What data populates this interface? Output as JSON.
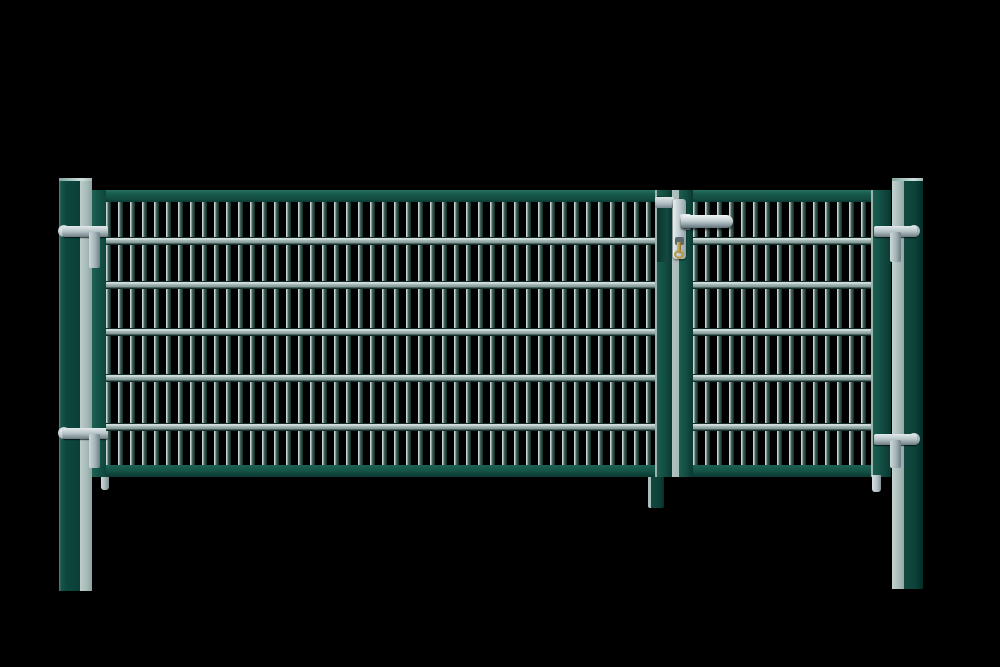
{
  "meta": {
    "description": "Product photograph on a black background: a green (moss-green RAL 6005) double-leaf driveway gate with galvanized double-wire mesh infill, mounted between two square green posts; chrome lever handle with brass key at the centre lock stile.",
    "background": "black"
  },
  "colors": {
    "bg": "#000000",
    "frame-green": "#15594c",
    "post-light": "#a7bbb9",
    "post-light-hi": "#bccbc9",
    "mesh-bar-light": "#c6d5d3",
    "rail-dark": "#142e29",
    "metal-light": "#e3eaec",
    "metal-mid": "#b4c2c6",
    "metal-dark": "#6c7c82",
    "brass": "#b89a4d",
    "brass-dark": "#7a6526"
  },
  "mesh": {
    "rail_offsets_px": [
      35,
      79,
      126,
      172,
      221
    ],
    "rail_height_px": 8,
    "vertical_bar_period_px": 12,
    "horizontal_rails_per_wing": 5
  },
  "scene": {
    "posts": [
      "left square post, dark green front with lit grey-green side",
      "right square post, lit grey-green side facing the gate"
    ],
    "wings": [
      "wide left leaf with welded mesh",
      "narrow right leaf with welded mesh and lock"
    ],
    "hardware": {
      "hinges": "four silver adjustable hinge bolts, two per post",
      "handle": "chrome lever handle pointing right on a long silver escutcheon",
      "key": "brass key inserted in the profile cylinder below the handle",
      "drop_rod": "green drop rod below the centre meeting stile",
      "ground_pins": "small silver stop pins below each leaf"
    }
  }
}
